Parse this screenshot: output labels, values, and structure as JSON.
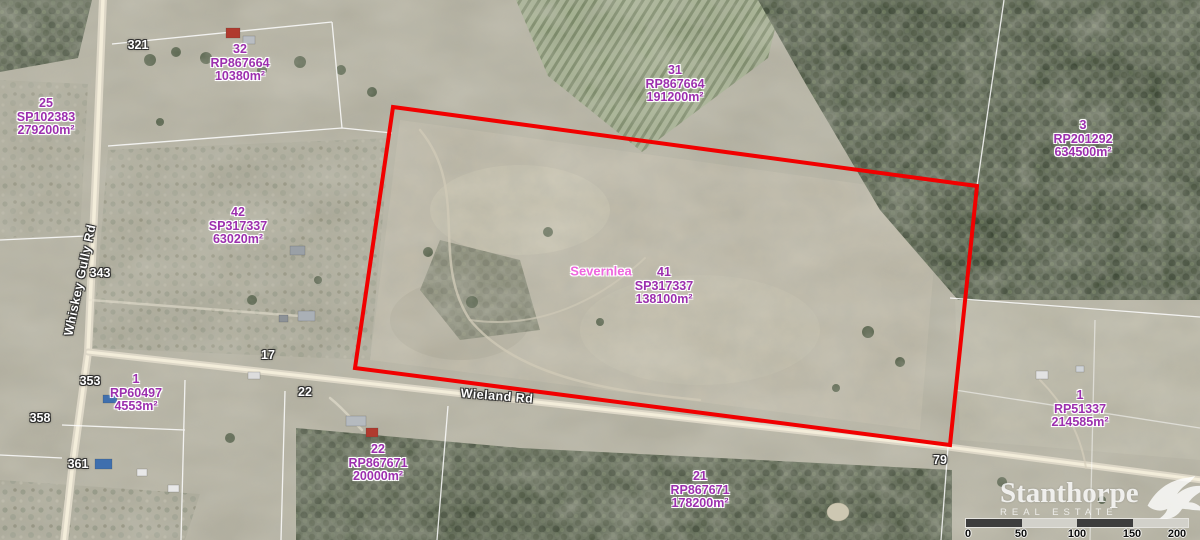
{
  "map": {
    "locality_label": "Severnlea",
    "parcels": [
      {
        "lot": "32",
        "plan": "RP867664",
        "area": "10380m²"
      },
      {
        "lot": "25",
        "plan": "SP102383",
        "area": "279200m²"
      },
      {
        "lot": "31",
        "plan": "RP867664",
        "area": "191200m²"
      },
      {
        "lot": "3",
        "plan": "RP201292",
        "area": "634500m²"
      },
      {
        "lot": "42",
        "plan": "SP317337",
        "area": "63020m²"
      },
      {
        "lot": "41",
        "plan": "SP317337",
        "area": "138100m²"
      },
      {
        "lot": "1",
        "plan": "RP60497",
        "area": "4553m²"
      },
      {
        "lot": "22",
        "plan": "RP867671",
        "area": "20000m²"
      },
      {
        "lot": "21",
        "plan": "RP867671",
        "area": "178200m²"
      },
      {
        "lot": "1",
        "plan": "RP51337",
        "area": "214585m²"
      }
    ],
    "roads": [
      {
        "name": "Whiskey Gully Rd"
      },
      {
        "name": "Wieland Rd"
      }
    ],
    "address_markers": [
      "321",
      "343",
      "17",
      "353",
      "358",
      "22",
      "361",
      "79"
    ],
    "colors": {
      "boundary_red": "#f10000",
      "parcel_text_purple": "#9c2fae",
      "locality_text_pink": "#ee66dd"
    }
  },
  "scalebar": {
    "ticks": [
      "0",
      "50",
      "100",
      "150",
      "200 m"
    ]
  },
  "logo": {
    "name": "Stanthorpe",
    "tagline": "REAL ESTATE"
  }
}
